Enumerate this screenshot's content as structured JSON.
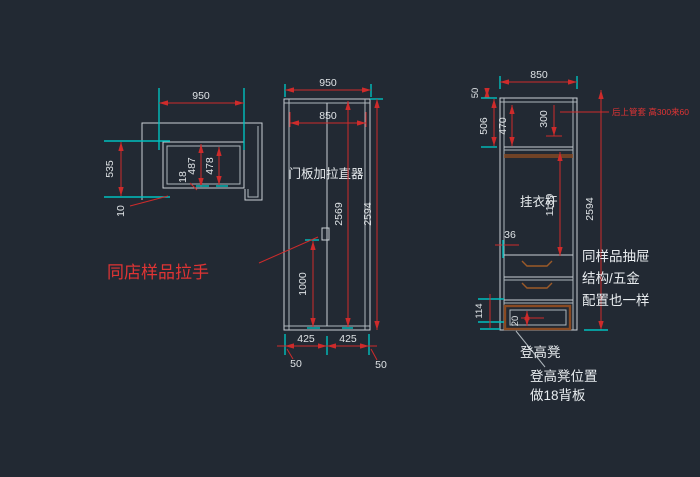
{
  "colors": {
    "background": "#222933",
    "line_gray": "#c9cfd4",
    "dimension_red": "#ce2b2b",
    "tick_cyan": "#00bfbf",
    "wood_brown": "#8a4a22",
    "text_white": "#e8ecef",
    "annotation_red": "#e03434"
  },
  "plan_view": {
    "dim_width": "950",
    "dim_depth": "535",
    "dim_panel": "18",
    "dim_inner_a": "487",
    "dim_inner_b": "478",
    "dim_gap": "10"
  },
  "front_view": {
    "dim_width": "950",
    "dim_inner_width": "850",
    "door_label": "门板加拉直器",
    "dim_door_height": "2569",
    "dim_total_height": "2594",
    "dim_handle_height": "1000",
    "dim_door_a": "425",
    "dim_door_b": "425",
    "dim_side_a": "50",
    "dim_side_b": "50",
    "handle_note": "同店样品拉手"
  },
  "side_view": {
    "dim_width": "850",
    "dim_top": "50",
    "dim_top_section": "506",
    "dim_inner_top": "470",
    "dim_rod_drop": "300",
    "pipe_note": "后上管套 高300来60",
    "rod_label": "挂衣杆",
    "dim_rod_height": "1189",
    "dim_total_height": "2594",
    "dim_36": "36",
    "dim_114": "114",
    "dim_20": "20",
    "drawer_note_line1": "同样品抽屉",
    "drawer_note_line2": "结构/五金",
    "drawer_note_line3": "配置也一样",
    "stool_label": "登高凳",
    "stool_note_line1": "登高凳位置",
    "stool_note_line2": "做18背板"
  }
}
